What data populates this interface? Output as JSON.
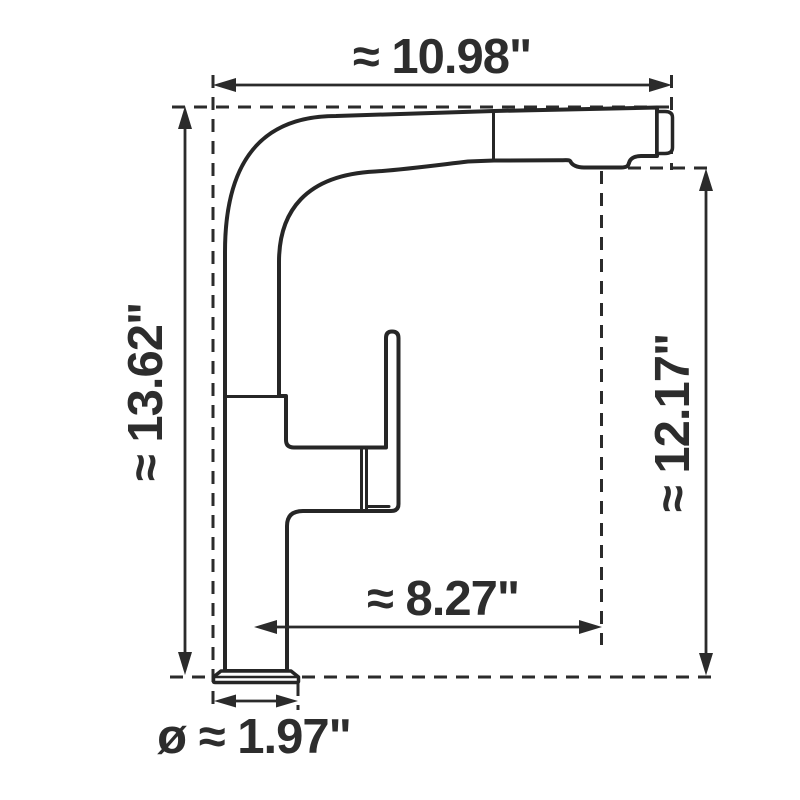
{
  "diagram": {
    "units": "inches",
    "line_color": "#2b2b2b",
    "background_color": "#ffffff",
    "dimensions": {
      "top_width": {
        "label": "≈ 10.98\"",
        "value": 10.98,
        "orientation": "horizontal"
      },
      "overall_height": {
        "label": "≈ 13.62\"",
        "value": 13.62,
        "orientation": "vertical"
      },
      "spout_height": {
        "label": "≈ 12.17\"",
        "value": 12.17,
        "orientation": "vertical"
      },
      "spout_reach": {
        "label": "≈ 8.27\"",
        "value": 8.27,
        "orientation": "horizontal"
      },
      "base_diameter": {
        "label": "ø ≈ 1.97\"",
        "value": 1.97,
        "orientation": "horizontal"
      }
    }
  }
}
